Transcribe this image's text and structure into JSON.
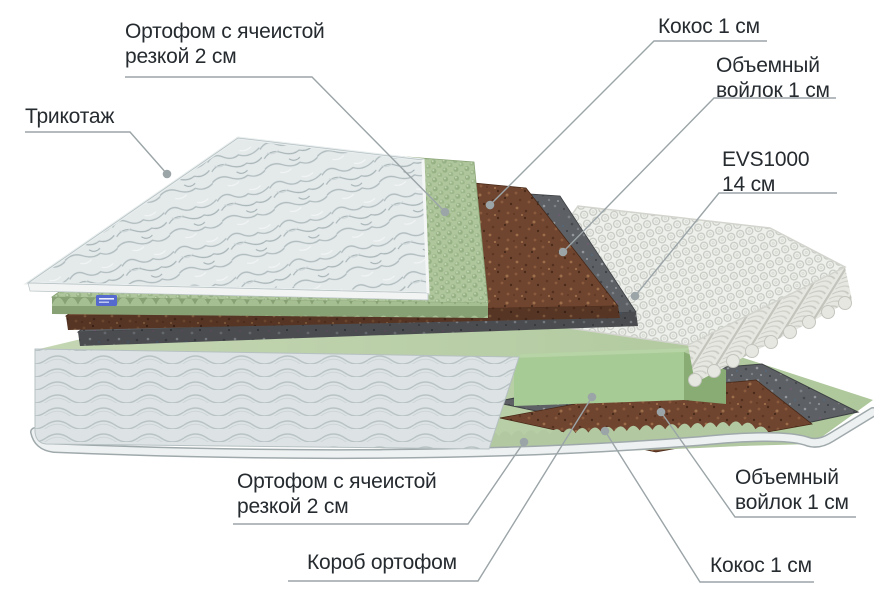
{
  "figure": {
    "type": "mattress-layers-diagram",
    "labels": {
      "ortofoam_top": {
        "text": "Ортофом с ячеистой\nрезкой 2 см"
      },
      "knit_cover": {
        "text": "Трикотаж"
      },
      "coconut_top": {
        "text": "Кокос 1 см"
      },
      "felt_top": {
        "text": "Объемный\nвойлок 1 см"
      },
      "springs_block": {
        "text": "EVS1000\n14 см"
      },
      "ortofoam_bottom": {
        "text": "Ортофом с ячеистой\nрезкой 2 см"
      },
      "foam_box": {
        "text": "Короб ортофом"
      },
      "felt_bottom": {
        "text": "Объемный\nвойлок 1 см"
      },
      "coconut_bottom": {
        "text": "Кокос 1 см"
      }
    },
    "colors": {
      "text": "#262b30",
      "leader": "#9ba4a7",
      "foam_green": "#afc69c",
      "foam_strip": "#9fb98c",
      "coconut_brown": "#6f4530",
      "felt_grey": "#5d6064",
      "springs_white": "#eef0ec",
      "base_green": "#b9cfa8",
      "box_green": "#a7cb95",
      "fabric_grey": "#dde3e4",
      "quilt_grey": "#e4e9ea",
      "tag_blue": "#5569cf"
    }
  }
}
